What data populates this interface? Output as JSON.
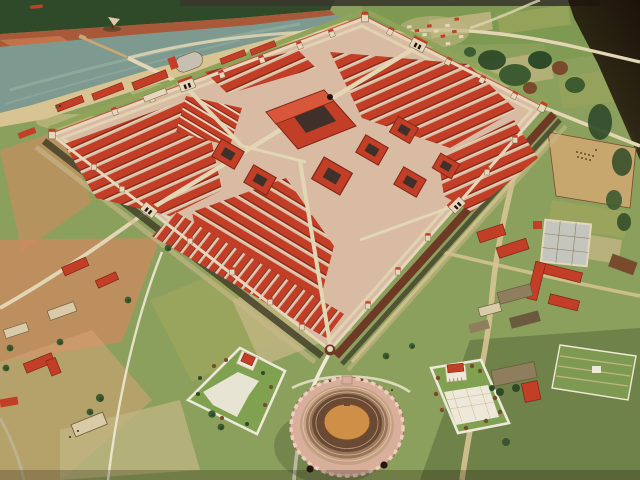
{
  "image": {
    "alt": "Aerial photograph of a museum diorama: a Roman legionary fortress model with dense red-tiled barracks inside a walled rectangle, a river with a pier and ship at top left, painted patchwork fields around, a stone amphitheatre and two white-walled temple precincts outside the south walls, a civilian settlement and parade ground to the east, and a dark backdrop in the top right corner.",
    "subject": "Roman fortress museum model",
    "width": "640",
    "height": "480"
  },
  "colors": {
    "base": "#8CA05D",
    "groundDark": "#6E8148",
    "salmon": "#CE8A60",
    "salmonLight": "#DBA377",
    "fieldTan": "#C2B583",
    "fieldOlive": "#9AA45C",
    "fieldGreen": "#7E9A52",
    "water": "#7E9A90",
    "waterLight": "#9FB7A8",
    "shoreSand": "#D8C393",
    "bank": "#A8593A",
    "bankLight": "#C77B4E",
    "treeDark": "#2F4A28",
    "treeMid": "#3D5B31",
    "bushBrown": "#7A4A2C",
    "backdrop": "#1D1208",
    "topBand": "#3A372B",
    "road": "#E2D6B4",
    "roadTan": "#D6C491",
    "pathWhite": "#EFE9D6",
    "roofRed": "#C23E27",
    "roofRedLight": "#D8573B",
    "roofDark": "#7E2616",
    "wallCream": "#E6D7BC",
    "streetPink": "#D8BBA2",
    "courtDark": "#40302A",
    "fortWallBrown": "#6E3A26",
    "ditch": "#44412A",
    "rampart": "#8FA458",
    "berm": "#CBB98B",
    "amphiStone": "#D7AF9B",
    "amphiCren": "#EBD0BD",
    "seatLight": "#C5A183",
    "seatMid": "#99765A",
    "seatDark": "#6B4A33",
    "arena": "#CE9047",
    "paveWhite": "#EDE8DA",
    "lawn": "#7FA150",
    "thatch": "#8F7E5E",
    "thatchDark": "#6A5A40",
    "grayVault": "#C6BFB2",
    "grayRoof": "#C4C6BE",
    "paradeTan": "#C8A76F",
    "creamHouse": "#D9CBA8",
    "shadow": "#3F4A2C",
    "figure": "#4A2A18",
    "boatHull": "#6B4527",
    "sail": "#D8CBA8",
    "pier": "#C9A873",
    "archDark": "#241710"
  }
}
